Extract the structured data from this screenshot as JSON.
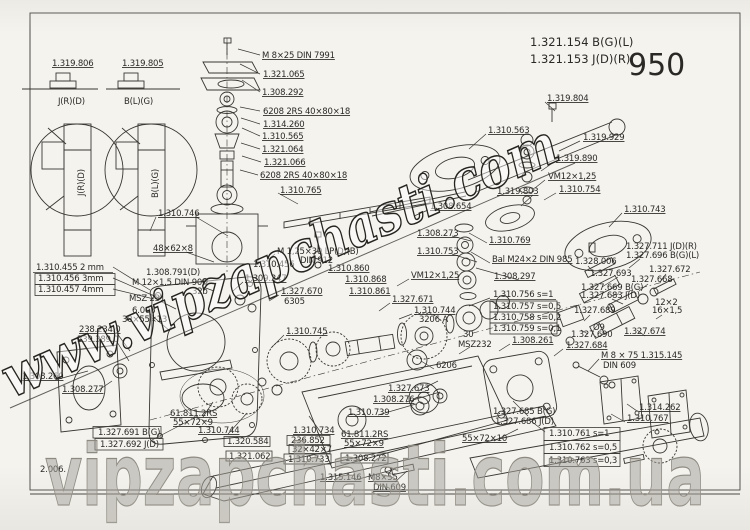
{
  "page": {
    "title_block": {
      "line1": "1.321.154  B(G)(L)",
      "line2": "1.321.153  J(D)(R)",
      "page_number": "950"
    },
    "watermarks": {
      "diagonal": "www.vipzapchasti.com",
      "bottom": "vipzapchasti.com.ua"
    }
  },
  "diagram": {
    "labels": [
      {
        "t": "1.319.806",
        "x": 52,
        "y": 66,
        "ul": 1
      },
      {
        "t": "1.319.805",
        "x": 122,
        "y": 66,
        "ul": 1
      },
      {
        "t": "J(R)(D)",
        "x": 58,
        "y": 104
      },
      {
        "t": "B(L)(G)",
        "x": 124,
        "y": 104
      },
      {
        "t": "J(R)(D)",
        "x": 84,
        "y": 196,
        "r": -90
      },
      {
        "t": "B(L)(G)",
        "x": 158,
        "y": 198,
        "r": -90
      },
      {
        "t": "M 8×25 DIN 7991",
        "x": 262,
        "y": 58,
        "ul": 1
      },
      {
        "t": "1.321.065",
        "x": 263,
        "y": 77,
        "ul": 1
      },
      {
        "t": "1.308.292",
        "x": 262,
        "y": 95,
        "ul": 1
      },
      {
        "t": "6208  2RS  40×80×18",
        "x": 263,
        "y": 114,
        "ul": 1
      },
      {
        "t": "1.314.260",
        "x": 263,
        "y": 127,
        "ul": 1
      },
      {
        "t": "1.310.565",
        "x": 262,
        "y": 139,
        "ul": 1
      },
      {
        "t": "1.321.064",
        "x": 262,
        "y": 152,
        "ul": 1
      },
      {
        "t": "1.321.066",
        "x": 264,
        "y": 165,
        "ul": 1
      },
      {
        "t": "6208 2RS 40×80×18",
        "x": 260,
        "y": 178,
        "ul": 1
      },
      {
        "t": "1.319.804",
        "x": 547,
        "y": 101,
        "ul": 1
      },
      {
        "t": "1.310.563",
        "x": 488,
        "y": 133,
        "ul": 1
      },
      {
        "t": "1.319.929",
        "x": 583,
        "y": 140,
        "ul": 1
      },
      {
        "t": "1.319.890",
        "x": 556,
        "y": 161,
        "ul": 1
      },
      {
        "t": "VM12×1,25",
        "x": 548,
        "y": 179,
        "ul": 1
      },
      {
        "t": "1.310.754",
        "x": 559,
        "y": 192,
        "ul": 1
      },
      {
        "t": "1.319.803",
        "x": 497,
        "y": 194,
        "ul": 1
      },
      {
        "t": "1.310.743",
        "x": 624,
        "y": 212,
        "ul": 1
      },
      {
        "t": "1.308.654",
        "x": 430,
        "y": 209,
        "ul": 1
      },
      {
        "t": "1.310.746",
        "x": 158,
        "y": 216,
        "ul": 1
      },
      {
        "t": "1.310.765",
        "x": 280,
        "y": 193,
        "ul": 1
      },
      {
        "t": "1.308.273",
        "x": 417,
        "y": 236,
        "ul": 1
      },
      {
        "t": "1.310.753",
        "x": 417,
        "y": 254,
        "ul": 1
      },
      {
        "t": "1.310.769",
        "x": 489,
        "y": 243,
        "ul": 1
      },
      {
        "t": "Bal M24×2 DIN 985",
        "x": 492,
        "y": 262,
        "ul": 1
      },
      {
        "t": "1.308.297",
        "x": 494,
        "y": 279,
        "ul": 1
      },
      {
        "t": "1.328.006",
        "x": 575,
        "y": 264
      },
      {
        "t": "1.327.711 J(D)(R)",
        "x": 626,
        "y": 249
      },
      {
        "t": "1.327.696 B(G)(L)",
        "x": 626,
        "y": 258
      },
      {
        "t": "1.327.693",
        "x": 590,
        "y": 276
      },
      {
        "t": "1.327.672",
        "x": 649,
        "y": 272
      },
      {
        "t": "1.327.668",
        "x": 631,
        "y": 282
      },
      {
        "t": "1.327.669 B(G)",
        "x": 581,
        "y": 290
      },
      {
        "t": "1.327.683 J(D)",
        "x": 581,
        "y": 298
      },
      {
        "t": "12×2",
        "x": 655,
        "y": 305
      },
      {
        "t": "16×1,5",
        "x": 652,
        "y": 313
      },
      {
        "t": "1.327.689",
        "x": 574,
        "y": 313
      },
      {
        "t": "Ø9",
        "x": 593,
        "y": 330
      },
      {
        "t": "1.327.690",
        "x": 571,
        "y": 337
      },
      {
        "t": "1.327.674",
        "x": 624,
        "y": 334,
        "ul": 1
      },
      {
        "t": "1.327.684",
        "x": 566,
        "y": 348,
        "ul": 1
      },
      {
        "t": "M 8 × 75  1.315.145",
        "x": 601,
        "y": 358,
        "ul": 1
      },
      {
        "t": "DIN 609",
        "x": 603,
        "y": 368
      },
      {
        "t": "1.314.262",
        "x": 639,
        "y": 410,
        "ul": 1
      },
      {
        "t": "1.310.767",
        "x": 627,
        "y": 421,
        "ul": 1
      },
      {
        "t": "48×62×8",
        "x": 153,
        "y": 251,
        "ul": 1
      },
      {
        "t": "1.310.455  2 mm",
        "x": 36,
        "y": 270
      },
      {
        "t": "1.310.456  3mm",
        "x": 38,
        "y": 281
      },
      {
        "t": "1.310.457  4mm",
        "x": 38,
        "y": 292
      },
      {
        "t": "1.308.791(D)",
        "x": 146,
        "y": 275
      },
      {
        "t": "M 12×1,5 DIN 906",
        "x": 132,
        "y": 285
      },
      {
        "t": "32b",
        "x": 192,
        "y": 294
      },
      {
        "t": "MSZ 231",
        "x": 129,
        "y": 301
      },
      {
        "t": "6.006",
        "x": 132,
        "y": 313
      },
      {
        "t": "30×55×13",
        "x": 122,
        "y": 322
      },
      {
        "t": "238.234.0",
        "x": 79,
        "y": 332,
        "ul": 1
      },
      {
        "t": "239.389.0",
        "x": 77,
        "y": 342
      },
      {
        "t": "1.308.260",
        "x": 22,
        "y": 379,
        "ul": 1
      },
      {
        "t": "1.308.277",
        "x": 62,
        "y": 392,
        "ul": 1
      },
      {
        "t": "M 1,25×30 LP(D)(B)",
        "x": 277,
        "y": 254
      },
      {
        "t": "DIN 912",
        "x": 300,
        "y": 263
      },
      {
        "t": "1.310.456",
        "x": 253,
        "y": 267
      },
      {
        "t": "1.309.247",
        "x": 245,
        "y": 281,
        "ul": 1
      },
      {
        "t": "1.327.670",
        "x": 281,
        "y": 294,
        "ul": 1
      },
      {
        "t": "6305",
        "x": 284,
        "y": 304
      },
      {
        "t": "1.310.860",
        "x": 328,
        "y": 271,
        "ul": 1
      },
      {
        "t": "1.310.868",
        "x": 345,
        "y": 282,
        "ul": 1
      },
      {
        "t": "1.310.861",
        "x": 349,
        "y": 294,
        "ul": 1
      },
      {
        "t": "VM12×1,25",
        "x": 411,
        "y": 278,
        "ul": 1
      },
      {
        "t": "1.327.671",
        "x": 392,
        "y": 302,
        "ul": 1
      },
      {
        "t": "1.310.744",
        "x": 414,
        "y": 313,
        "ul": 1
      },
      {
        "t": "3206 A",
        "x": 419,
        "y": 322
      },
      {
        "t": "1.310.745",
        "x": 286,
        "y": 334,
        "ul": 1
      },
      {
        "t": "1.310.756  s=1",
        "x": 493,
        "y": 297
      },
      {
        "t": "1.310.757  s=0,5",
        "x": 493,
        "y": 309
      },
      {
        "t": "1.310.758  s=0,2",
        "x": 493,
        "y": 320
      },
      {
        "t": "1.310.759  s=0,1",
        "x": 493,
        "y": 331
      },
      {
        "t": "30",
        "x": 463,
        "y": 337
      },
      {
        "t": "MSZ232",
        "x": 458,
        "y": 347
      },
      {
        "t": "1.308.261",
        "x": 512,
        "y": 343,
        "ul": 1
      },
      {
        "t": "6206",
        "x": 436,
        "y": 368
      },
      {
        "t": "1.327.673",
        "x": 388,
        "y": 391,
        "ul": 1
      },
      {
        "t": "1.308.276",
        "x": 373,
        "y": 402,
        "ul": 1
      },
      {
        "t": "1.310.739",
        "x": 348,
        "y": 415,
        "ul": 1
      },
      {
        "t": "61.811.2RS",
        "x": 170,
        "y": 416,
        "ul": 1
      },
      {
        "t": "55×72×9",
        "x": 173,
        "y": 425,
        "ul": 1
      },
      {
        "t": "1.327.691 B(G)",
        "x": 98,
        "y": 435
      },
      {
        "t": "1.327.692 J(D)",
        "x": 100,
        "y": 447
      },
      {
        "t": "1.310.744",
        "x": 198,
        "y": 433,
        "ul": 1
      },
      {
        "t": "1.320.584",
        "x": 227,
        "y": 444
      },
      {
        "t": "1.321.062",
        "x": 229,
        "y": 459
      },
      {
        "t": "1.310.734",
        "x": 293,
        "y": 433,
        "ul": 1
      },
      {
        "t": "236.852",
        "x": 291,
        "y": 443
      },
      {
        "t": "32×42×7",
        "x": 292,
        "y": 452
      },
      {
        "t": "1.310.733",
        "x": 288,
        "y": 462
      },
      {
        "t": "1.308.272",
        "x": 345,
        "y": 461
      },
      {
        "t": "61.811.2RS",
        "x": 341,
        "y": 437,
        "ul": 1
      },
      {
        "t": "55×72×9",
        "x": 344,
        "y": 446,
        "ul": 1
      },
      {
        "t": "55×72×10",
        "x": 462,
        "y": 441,
        "ul": 1
      },
      {
        "t": "1.327.685 B(G)",
        "x": 493,
        "y": 414
      },
      {
        "t": "1.327.686 J(D)",
        "x": 495,
        "y": 424
      },
      {
        "t": "1.310.761  s=1",
        "x": 549,
        "y": 436
      },
      {
        "t": "1.310.762  s=0,5",
        "x": 549,
        "y": 450
      },
      {
        "t": "1.310.763  s=0,3",
        "x": 549,
        "y": 463
      },
      {
        "t": "1.315.146",
        "x": 320,
        "y": 480,
        "ul": 1
      },
      {
        "t": "M8×55",
        "x": 368,
        "y": 480,
        "ul": 1
      },
      {
        "t": "DIN 609",
        "x": 373,
        "y": 490,
        "ul": 1
      },
      {
        "t": "2.006.",
        "x": 40,
        "y": 472
      }
    ]
  }
}
